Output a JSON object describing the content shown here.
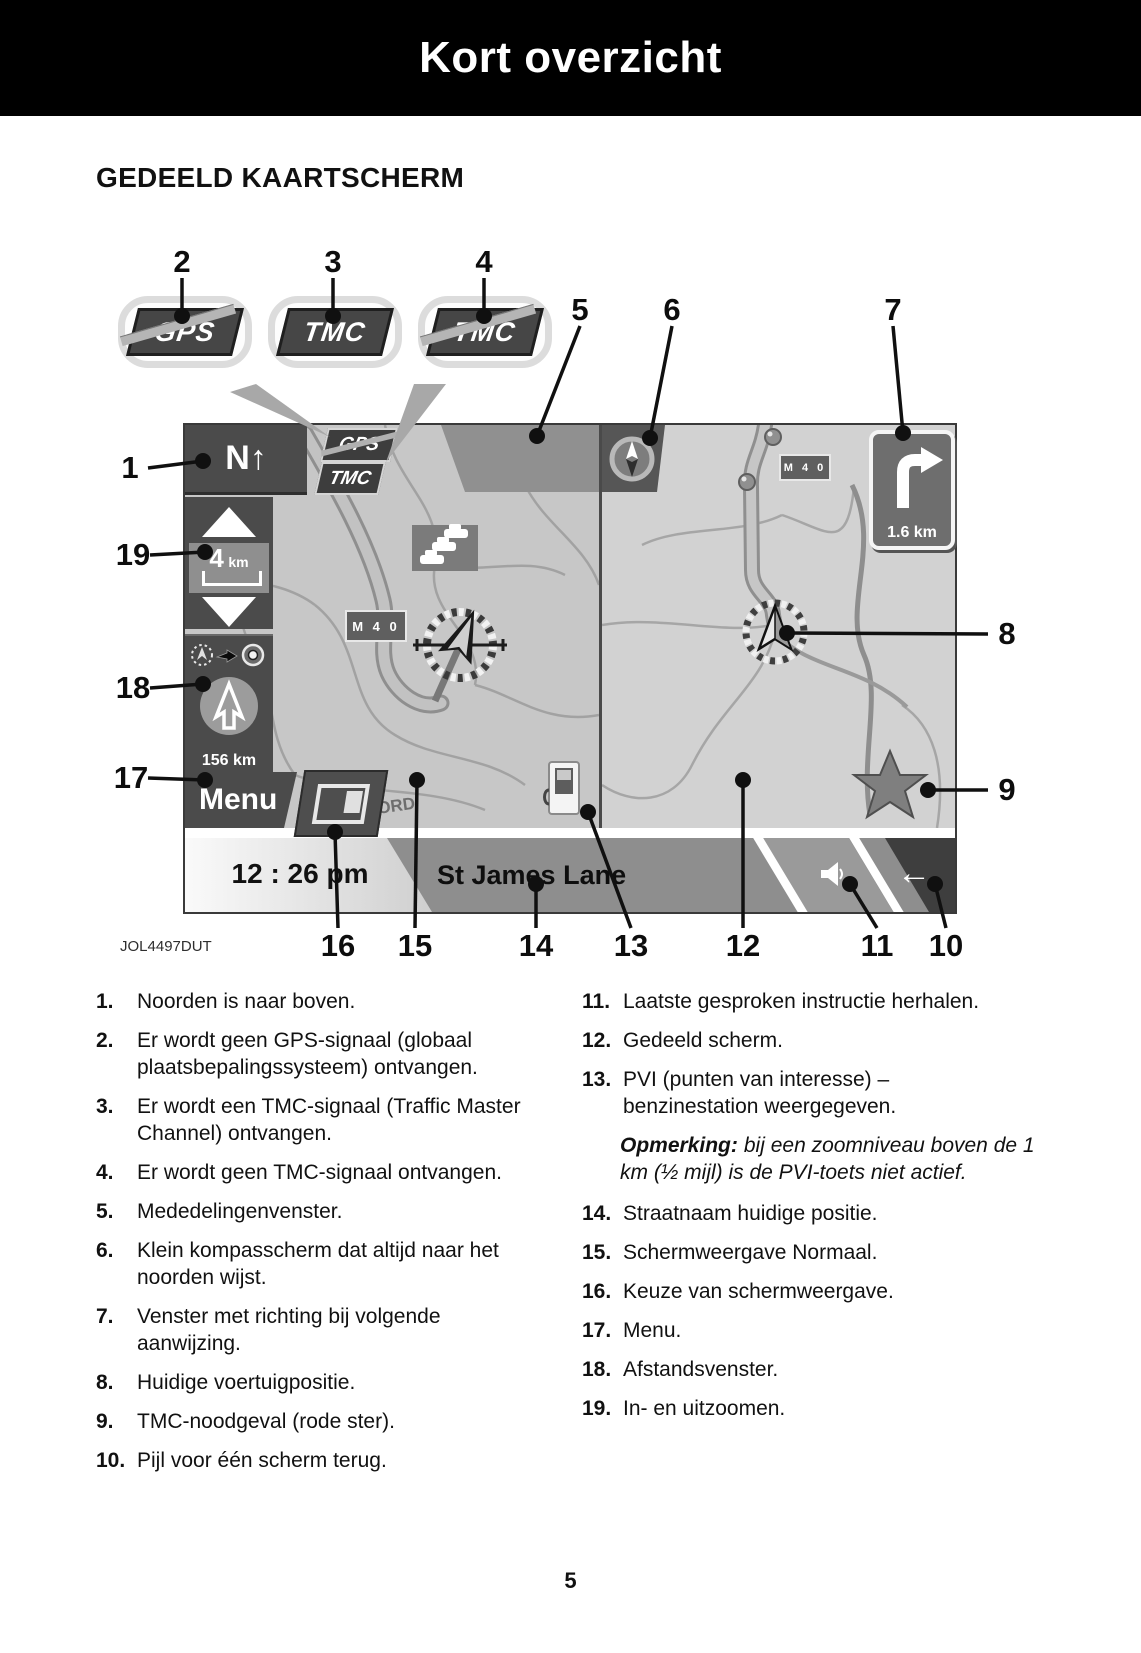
{
  "page": {
    "title": "Kort overzicht",
    "section_title": "GEDEELD KAARTSCHERM",
    "figure_code": "JOL4497DUT",
    "page_number": "5"
  },
  "legend_badges": {
    "gps_no_signal": "GPS",
    "tmc_signal": "TMC",
    "tmc_no_signal": "TMC"
  },
  "screen": {
    "north_button": "N↑",
    "gps_badge": "GPS",
    "tmc_badge": "TMC",
    "zoom_scale": "4",
    "zoom_unit": "km",
    "distance_window": "156 km",
    "menu_button": "Menu",
    "road_badge_left": "M 4 0",
    "road_badge_right": "M 4 0",
    "turn_distance": "1.6 km",
    "map_label": "FORD",
    "time_display": "12 : 26 pm",
    "street_name": "St James Lane",
    "back_arrow": "←"
  },
  "callouts": {
    "c1": "1",
    "c2": "2",
    "c3": "3",
    "c4": "4",
    "c5": "5",
    "c6": "6",
    "c7": "7",
    "c8": "8",
    "c9": "9",
    "c10": "10",
    "c11": "11",
    "c12": "12",
    "c13": "13",
    "c14": "14",
    "c15": "15",
    "c16": "16",
    "c17": "17",
    "c18": "18",
    "c19": "19"
  },
  "legend_left": [
    {
      "n": "1.",
      "t": "Noorden is naar boven."
    },
    {
      "n": "2.",
      "t": "Er wordt geen GPS-signaal (globaal plaatsbepalingssysteem) ontvangen."
    },
    {
      "n": "3.",
      "t": "Er wordt een TMC-signaal (Traffic Master Channel) ontvangen."
    },
    {
      "n": "4.",
      "t": "Er wordt geen TMC-signaal ontvangen."
    },
    {
      "n": "5.",
      "t": "Mededelingenvenster."
    },
    {
      "n": "6.",
      "t": "Klein kompasscherm dat altijd naar het noorden wijst."
    },
    {
      "n": "7.",
      "t": "Venster met richting bij volgende aanwijzing."
    },
    {
      "n": "8.",
      "t": "Huidige voertuigpositie."
    },
    {
      "n": "9.",
      "t": "TMC-noodgeval (rode ster)."
    },
    {
      "n": "10.",
      "t": "Pijl voor één scherm terug."
    }
  ],
  "legend_right": [
    {
      "n": "11.",
      "t": "Laatste gesproken instructie herhalen."
    },
    {
      "n": "12.",
      "t": "Gedeeld scherm."
    },
    {
      "n": "13.",
      "t": "PVI (punten van interesse) – benzinestation weergegeven."
    },
    {
      "n": "14.",
      "t": "Straatnaam huidige positie."
    },
    {
      "n": "15.",
      "t": "Schermweergave Normaal."
    },
    {
      "n": "16.",
      "t": "Keuze van schermweergave."
    },
    {
      "n": "17.",
      "t": "Menu."
    },
    {
      "n": "18.",
      "t": "Afstandsvenster."
    },
    {
      "n": "19.",
      "t": "In- en uitzoomen."
    }
  ],
  "note": {
    "label": "Opmerking:",
    "text": "bij een zoomniveau boven de 1 km (½ mijl) is de PVI-toets niet actief."
  }
}
